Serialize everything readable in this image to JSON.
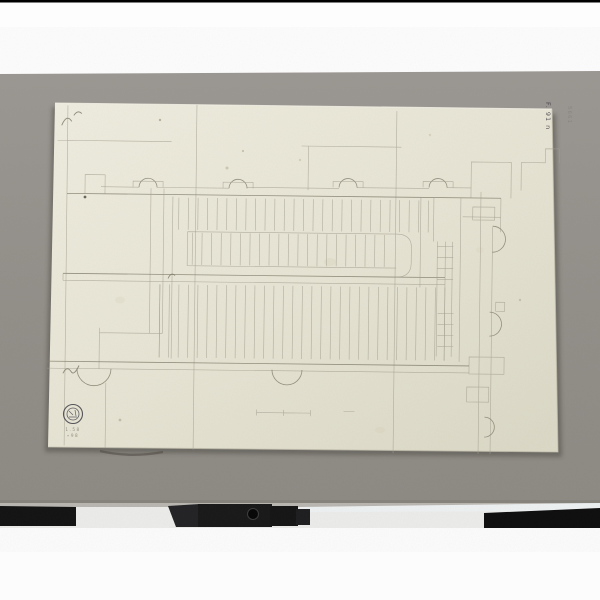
{
  "colors": {
    "backdrop_white": "#fdfdfd",
    "board_gray": "#959089",
    "board_gray_dark": "#8b8781",
    "paper_cream": "#e8e5d5",
    "paper_cream_light": "#eeecdf",
    "paper_cream_dark": "#dbd8c6",
    "pencil": "#a49f8f",
    "pencil_dark": "#84806f",
    "stamp_ink": "#3a3942",
    "equipment_black": "#111111"
  },
  "paper": {
    "corner_inscription": "F. 91 n",
    "stamp_caption_line1": "1.58",
    "stamp_caption_line2": "∙98"
  },
  "mat": {
    "inscription": "5661"
  }
}
